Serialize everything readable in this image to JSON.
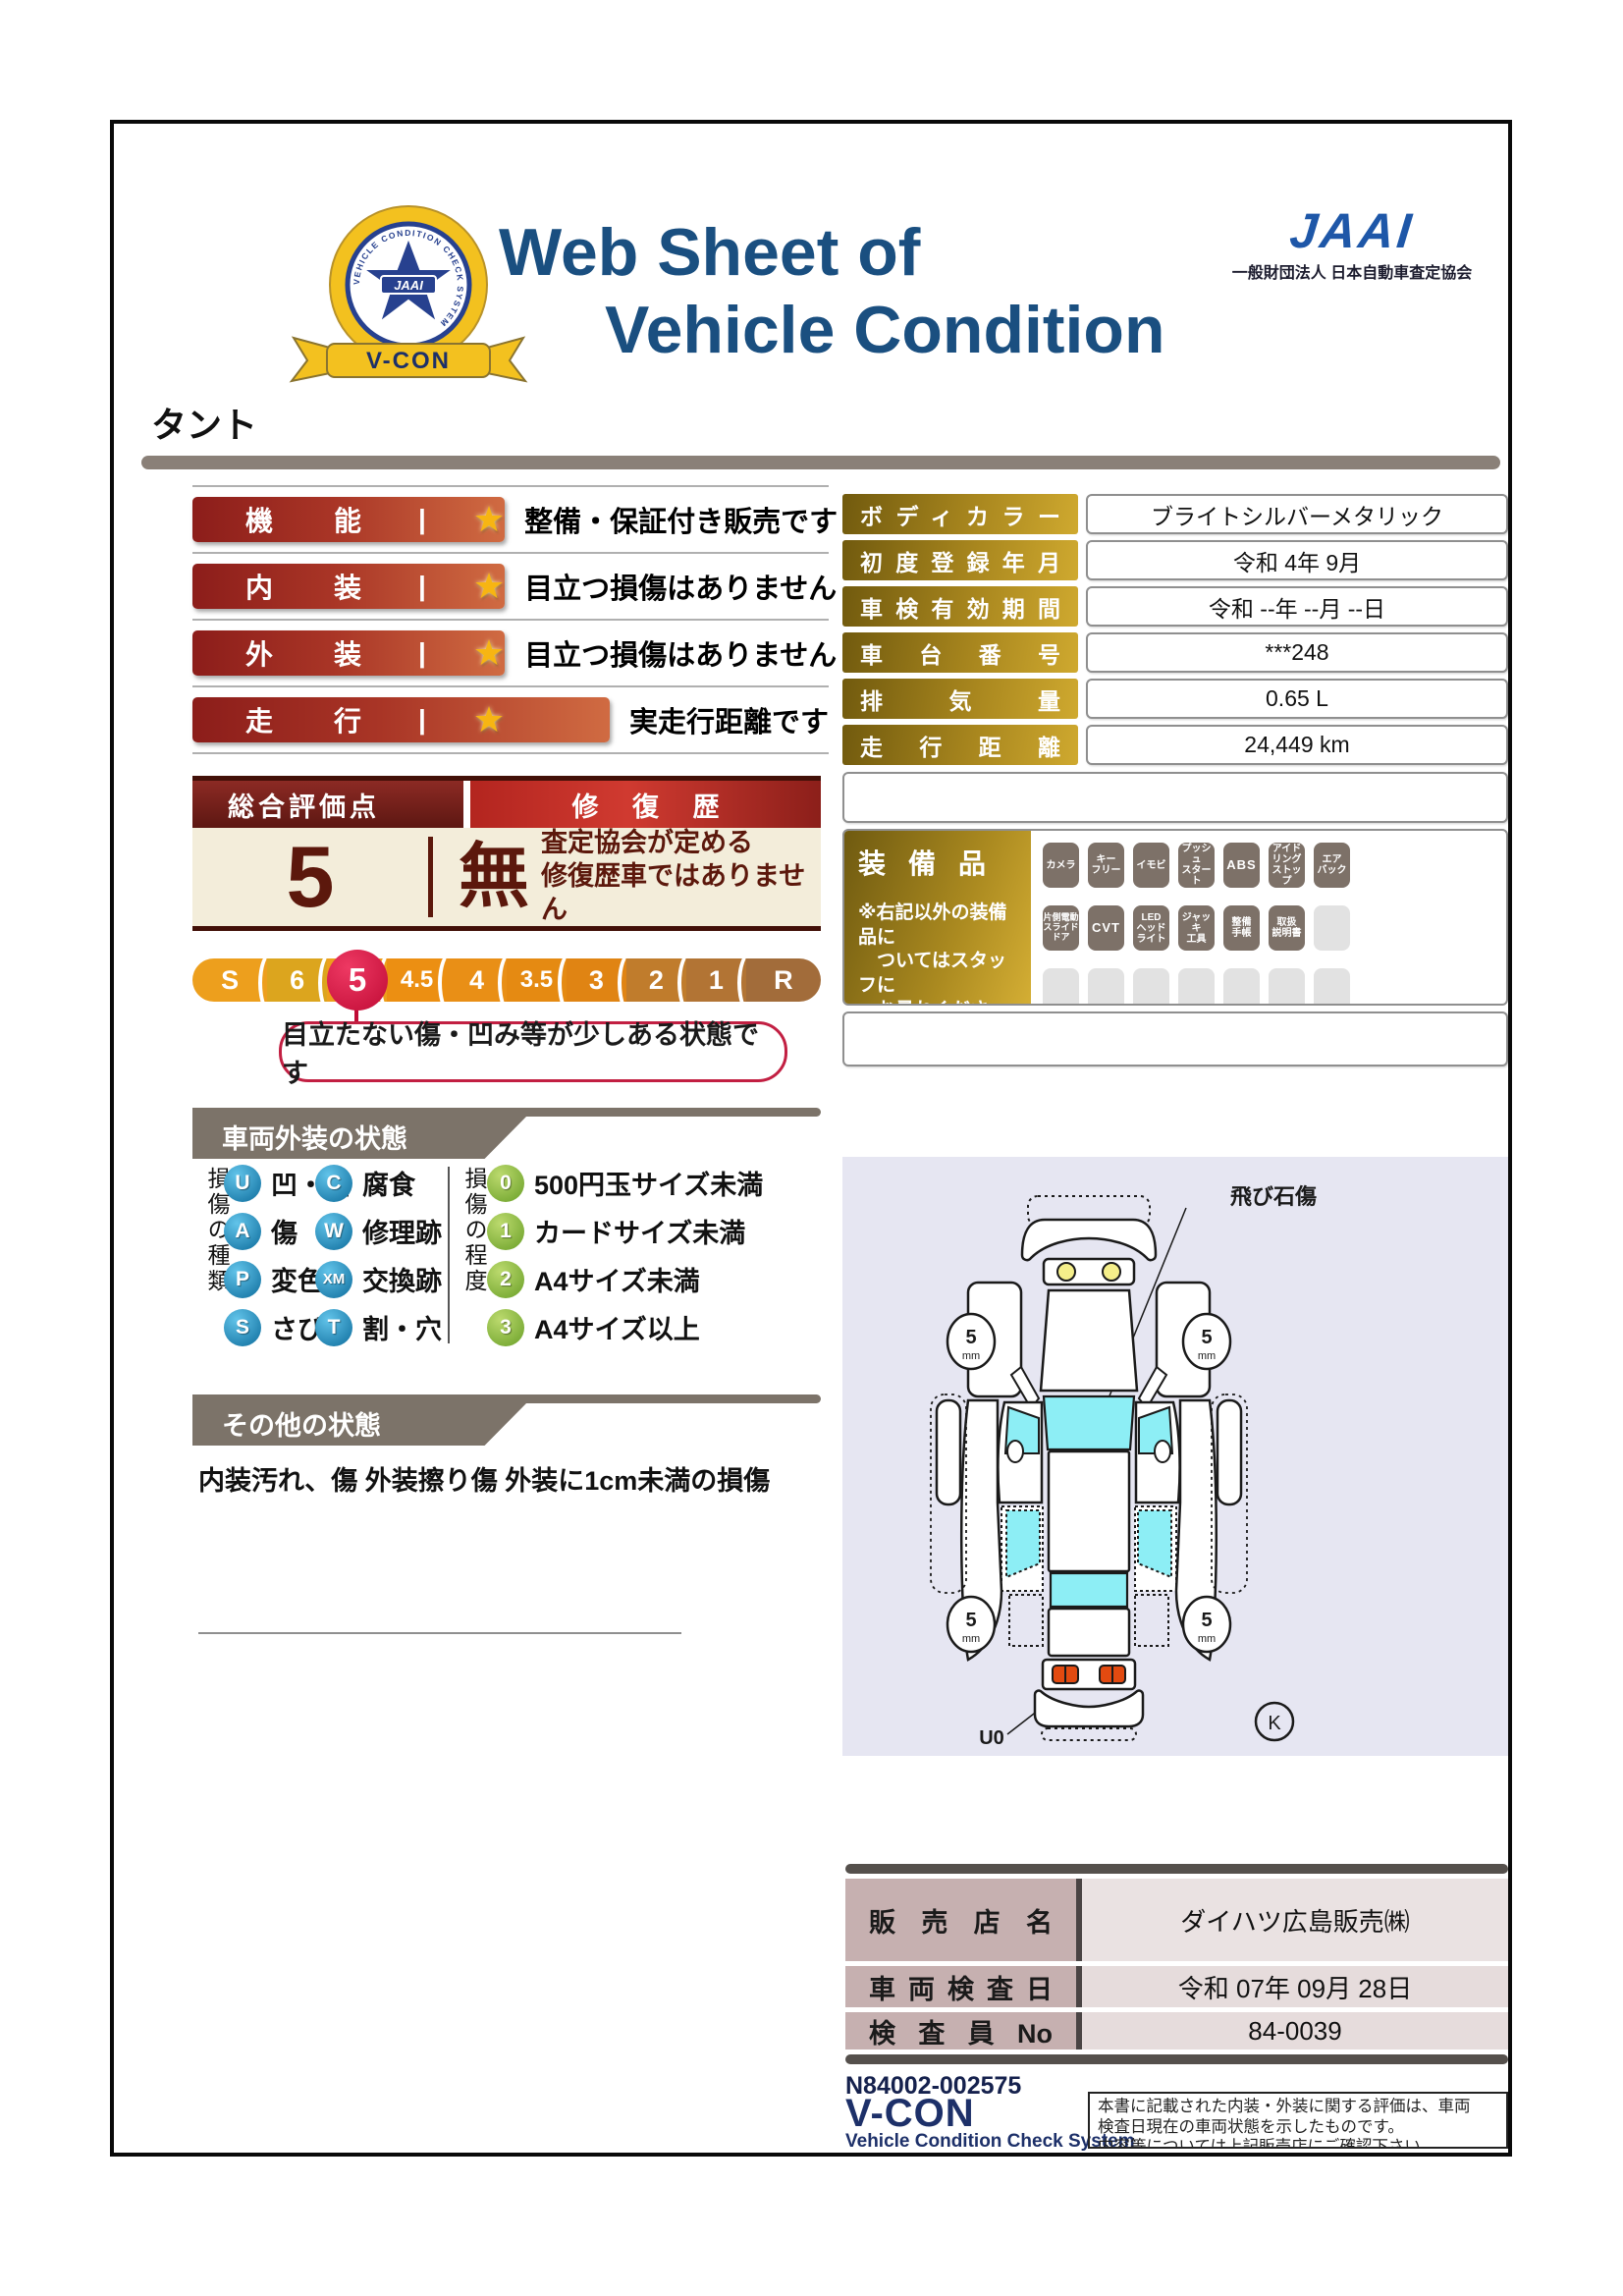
{
  "header": {
    "title_line1": "Web Sheet of",
    "title_line2": "Vehicle Condition",
    "jaai_logo_text": "JAAI",
    "jaai_subtitle": "一般財団法人 日本自動車査定協会",
    "badge": {
      "ribbon": "V-CON",
      "center": "JAAI",
      "ring_text": "VEHICLE CONDITION CHECK SYSTEM"
    }
  },
  "vehicle_name": "タント",
  "ratings": [
    {
      "label": "機能",
      "star": "★",
      "description": "整備・保証付き販売です"
    },
    {
      "label": "内装",
      "star": "★",
      "description": "目立つ損傷はありません"
    },
    {
      "label": "外装",
      "star": "★",
      "description": "目立つ損傷はありません"
    },
    {
      "label": "走行",
      "star": "★",
      "description": "実走行距離です"
    }
  ],
  "overall": {
    "header_left": "総合評価点",
    "header_right": "修復歴",
    "score": "5",
    "repair_value": "無",
    "repair_note_line1": "査定協会が定める",
    "repair_note_line2": "修復歴車ではありません"
  },
  "scale": {
    "segments": [
      "S",
      "6",
      "5",
      "4.5",
      "4",
      "3.5",
      "3",
      "2",
      "1",
      "R"
    ],
    "selected": "5",
    "callout": "目立たない傷・凹み等が少しある状態です"
  },
  "info_table": {
    "rows": [
      {
        "label": "ボディカラー",
        "value": "ブライトシルバーメタリック"
      },
      {
        "label": "初度登録年月",
        "value": "令和 4年 9月"
      },
      {
        "label": "車検有効期間",
        "value": "令和 --年 --月 --日"
      },
      {
        "label": "車台番号",
        "value": "***248"
      },
      {
        "label": "排気量",
        "value": "0.65 L"
      },
      {
        "label": "走行距離",
        "value": "24,449 km"
      }
    ]
  },
  "equipment": {
    "title": "装備品",
    "note": "※右記以外の装備品に\n　ついてはスタッフに\n　お尋ねください。",
    "badges_row1": [
      "カメラ",
      "キー\nフリー",
      "イモビ",
      "プッシュ\nスタート",
      "ABS",
      "アイド\nリング\nストップ",
      "エア\nバック"
    ],
    "badges_row2": [
      "片側電動\nスライド\nドア",
      "CVT",
      "LED\nヘッド\nライト",
      "ジャッキ\n工具",
      "整備\n手帳",
      "取扱\n説明書"
    ]
  },
  "exterior": {
    "section_title": "車両外装の状態",
    "types_title": "損傷の種類",
    "types": [
      {
        "code": "U",
        "label": "凹・曲"
      },
      {
        "code": "A",
        "label": "傷"
      },
      {
        "code": "P",
        "label": "変色"
      },
      {
        "code": "S",
        "label": "さび"
      },
      {
        "code": "C",
        "label": "腐食"
      },
      {
        "code": "W",
        "label": "修理跡"
      },
      {
        "code": "XM",
        "label": "交換跡"
      },
      {
        "code": "T",
        "label": "割・穴"
      }
    ],
    "degrees_title": "損傷の程度",
    "degrees": [
      {
        "code": "0",
        "label": "500円玉サイズ未満"
      },
      {
        "code": "1",
        "label": "カードサイズ未満"
      },
      {
        "code": "2",
        "label": "A4サイズ未満"
      },
      {
        "code": "3",
        "label": "A4サイズ以上"
      }
    ]
  },
  "other": {
    "section_title": "その他の状態",
    "text": "内装汚れ、傷 外装擦り傷 外装に1cm未満の損傷"
  },
  "diagram": {
    "damage_label": "飛び石傷",
    "damage_code": "U0",
    "wheel_note": "5",
    "wheel_unit": "mm",
    "corner_mark": "K"
  },
  "dealer_table": {
    "rows": [
      {
        "label": "販売店名",
        "value": "ダイハツ広島販売㈱"
      },
      {
        "label": "車両検査日",
        "value": "令和 07年 09月 28日"
      },
      {
        "label": "検査員No",
        "value": "84-0039"
      }
    ]
  },
  "footer": {
    "doc_number": "N84002-002575",
    "vcon_logo": "V-CON",
    "vcon_subtitle": "Vehicle Condition Check System",
    "disclaimer_line1": "本書に記載された内装・外装に関する評価は、車両",
    "disclaimer_line2": "検査日現在の車両状態を示したものです。",
    "disclaimer_line3": "内容等については上記販売店にご確認下さい。"
  },
  "colors": {
    "navy_title": "#1a4f80",
    "maroon": "#5c180c",
    "accent_red": "#c21f42",
    "gold_label": "#a8861e",
    "badge_gray": "#7d7168",
    "glass_cyan": "#8deef5",
    "scale_red": "#c00b35"
  }
}
